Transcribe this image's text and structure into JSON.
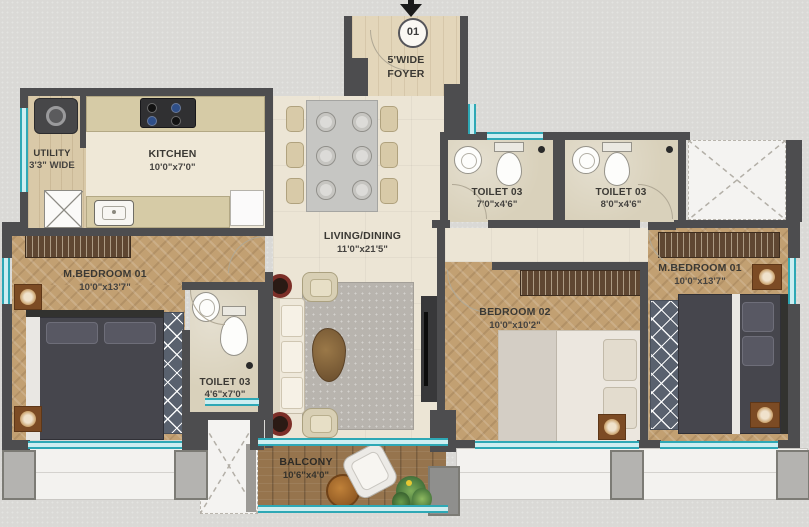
{
  "palette": {
    "background": "#dad9d6",
    "wall": "#4d4d4f",
    "window_teal": "#2ea8b5",
    "wood_floor": "#c2a072",
    "tile_floor": "#ece5d5",
    "balcony_wood": "#96744d",
    "wardrobe_brown": "#5f4732",
    "bed_dark": "#46464d",
    "label_text": "#3b3934"
  },
  "entry": {
    "door_number": "01"
  },
  "rooms": {
    "foyer": {
      "label": "5'WIDE",
      "sub": "FOYER"
    },
    "utility": {
      "label": "UTILITY",
      "sub": "3'3\" WIDE"
    },
    "kitchen": {
      "label": "KITCHEN",
      "sub": "10'0\"x7'0\""
    },
    "living_dining": {
      "label": "LIVING/DINING",
      "sub": "11'0\"x21'5\""
    },
    "toilet_top_left": {
      "label": "TOILET 03",
      "sub": "7'0\"x4'6\""
    },
    "toilet_top_right": {
      "label": "TOILET 03",
      "sub": "8'0\"x4'6\""
    },
    "toilet_master_left": {
      "label": "TOILET 03",
      "sub": "4'6\"x7'0\""
    },
    "master_bedroom_left": {
      "label": "M.BEDROOM 01",
      "sub": "10'0\"x13'7\""
    },
    "bedroom_02": {
      "label": "BEDROOM 02",
      "sub": "10'0\"x10'2\""
    },
    "master_bedroom_right": {
      "label": "M.BEDROOM 01",
      "sub": "10'0\"x13'7\""
    },
    "balcony": {
      "label": "BALCONY",
      "sub": "10'6\"x4'0\""
    }
  }
}
